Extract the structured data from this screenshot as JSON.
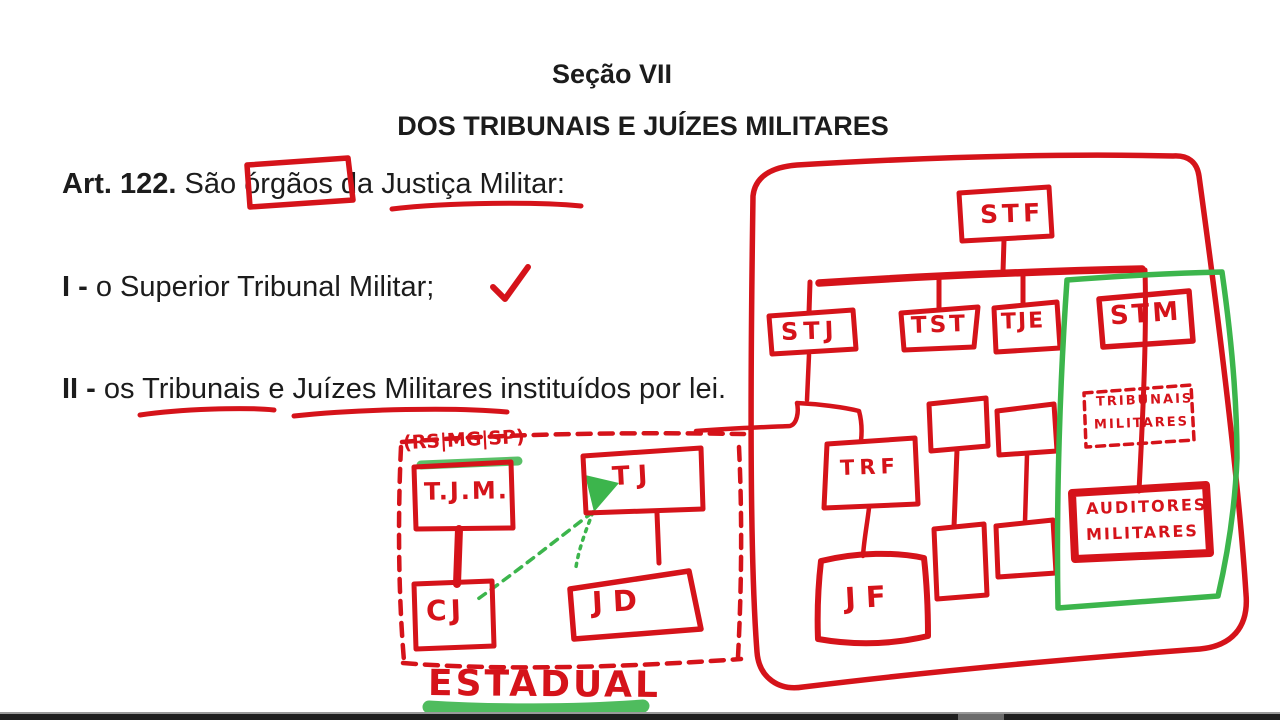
{
  "document": {
    "section_heading": "Seção VII",
    "title": "DOS TRIBUNAIS E JUÍZES MILITARES",
    "article": {
      "label": "Art. 122.",
      "pre": " São ",
      "boxed_word": "órgãos",
      "mid": " da ",
      "underlined_phrase": "Justiça Militar",
      "suffix": ":"
    },
    "items": [
      {
        "numeral": "I -",
        "text": " o Superior Tribunal Militar;"
      },
      {
        "numeral": "II -",
        "pre": " os ",
        "underlined1": "Tribunais",
        "mid": " e ",
        "underlined2": "Juízes Militares",
        "suffix": " instituídos por lei."
      }
    ]
  },
  "federal_diagram": {
    "stf_label": "STF",
    "stj_label": "STJ",
    "tst_label": "TST",
    "tje_label": "TJE",
    "stm_label": "STM",
    "trf_label": "TRF",
    "jf_label": "JF",
    "tribunais_militares_line1": "TRIBUNAIS",
    "tribunais_militares_line2": "MILITARES",
    "auditores_line1": "AUDITORES",
    "auditores_line2": "MILITARES"
  },
  "estadual_diagram": {
    "states_note": "(RS|MG|SP)",
    "tjm_label": "T.J.M.",
    "tj_label": "TJ",
    "cj_label": "CJ",
    "jd_label": "JD",
    "caption": "ESTADUAL"
  },
  "colors": {
    "annotation_red": "#d5131a",
    "annotation_green": "#3cb54c",
    "text_ink": "#1c1c1c"
  }
}
